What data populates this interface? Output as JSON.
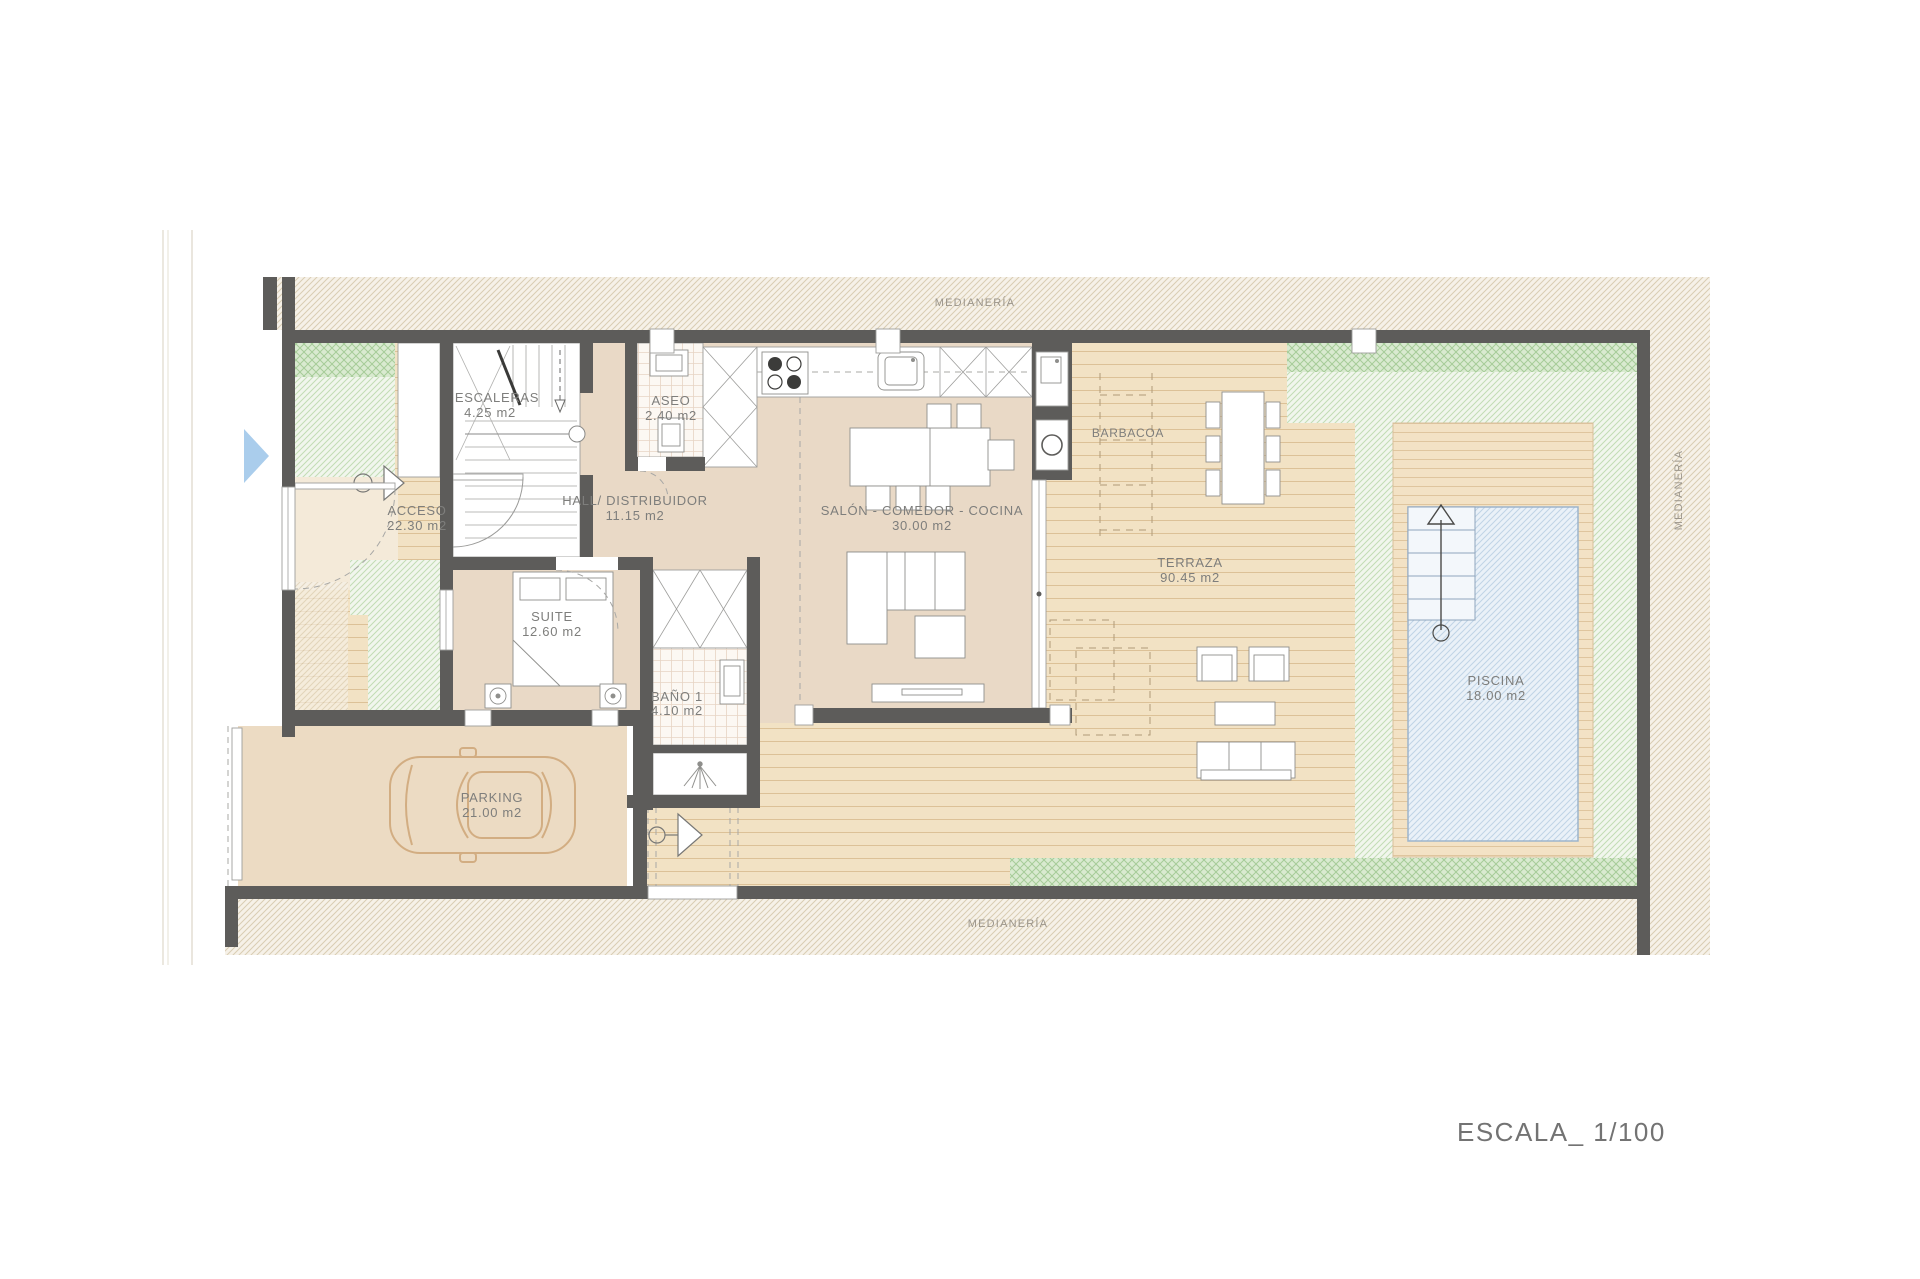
{
  "title_block": {
    "scale_label": "ESCALA_ 1/100"
  },
  "boundaries": {
    "top": "MEDIANERÍA",
    "bottom": "MEDIANERÍA",
    "right": "MEDIANERÍA"
  },
  "rooms": {
    "escaleras": {
      "name": "ESCALERAS",
      "area": "4.25 m2"
    },
    "aseo": {
      "name": "ASEO",
      "area": "2.40 m2"
    },
    "acceso": {
      "name": "ACCESO",
      "area": "22.30 m2"
    },
    "hall": {
      "name": "HALL/ DISTRIBUIDOR",
      "area": "11.15 m2"
    },
    "salon": {
      "name": "SALÓN - COMEDOR - COCINA",
      "area": "30.00 m2"
    },
    "suite": {
      "name": "SUITE",
      "area": "12.60 m2"
    },
    "bano1": {
      "name": "BAÑO 1",
      "area": "4.10 m2"
    },
    "parking": {
      "name": "PARKING",
      "area": "21.00 m2"
    },
    "terraza": {
      "name": "TERRAZA",
      "area": "90.45 m2"
    },
    "piscina": {
      "name": "PISCINA",
      "area": "18.00 m2"
    },
    "barbacoa": {
      "name": "BARBACOA"
    }
  },
  "colors": {
    "wall": "#5d5c5a",
    "floor": "#e9d9c6",
    "deck": "#f2e2c4",
    "pool": "#eaf1f8",
    "label": "#7e7e7c",
    "arrow_blue": "#aacdec"
  }
}
